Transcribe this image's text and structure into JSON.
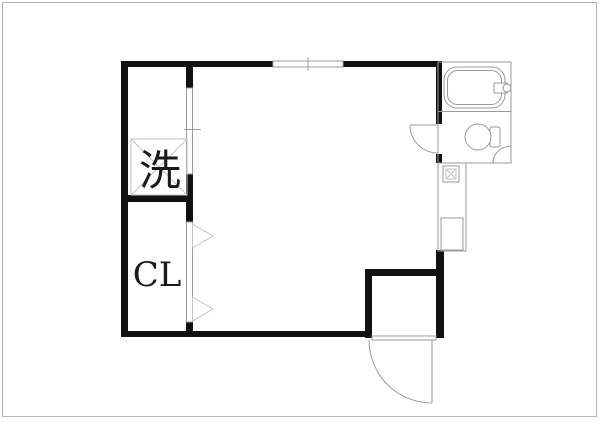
{
  "plan": {
    "type": "floor-plan",
    "labels": {
      "laundry": "洗",
      "closet": "CL"
    },
    "fixtures": [
      "bathtub",
      "bath-faucet",
      "toilet",
      "corner-shelf",
      "kitchen-stove",
      "kitchen-sink",
      "washing-machine-space",
      "closet-folding-door",
      "laundry-sliding-door",
      "top-window",
      "toilet-door",
      "entrance-door"
    ],
    "colors": {
      "wall": "#111111",
      "line": "#9a9a9a",
      "text": "#1a1a1a",
      "bg": "#ffffff",
      "border": "#b5b5b5"
    }
  }
}
